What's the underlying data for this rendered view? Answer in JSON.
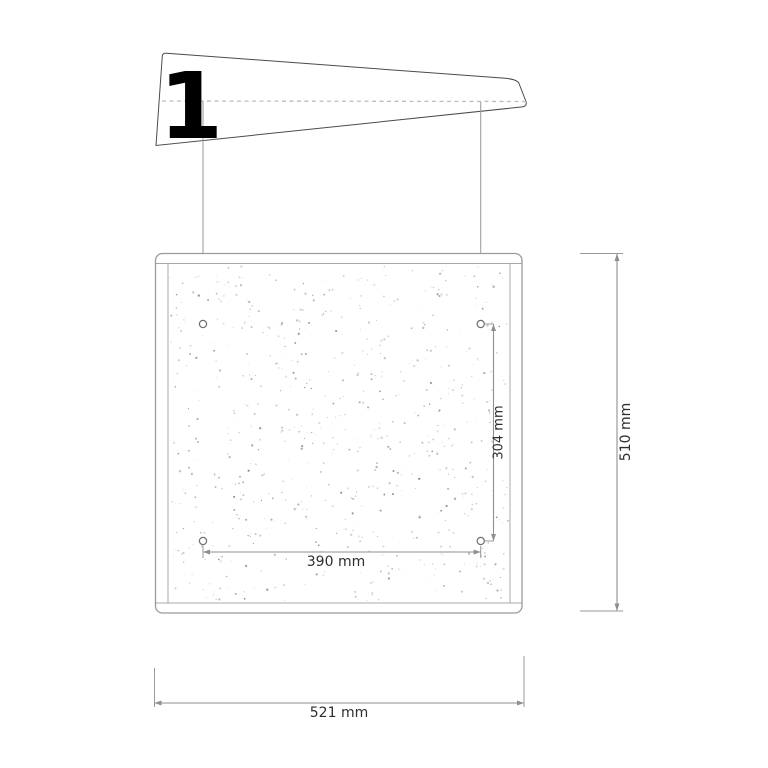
{
  "flag": {
    "label": "1"
  },
  "panel": {
    "width_label": "521 mm",
    "height_label": "510 mm"
  },
  "holes": {
    "horizontal_spacing_label": "390 mm",
    "vertical_spacing_label": "304 mm"
  },
  "colors": {
    "background": "#ffffff",
    "flag_outline": "#4a4a4a",
    "flag_number": "#000000",
    "panel_frame": "#9a9a9a",
    "dashed_centerline": "#bdbdbd",
    "dimension_line": "#8f8f8f",
    "label_text": "#2e2e2e"
  }
}
